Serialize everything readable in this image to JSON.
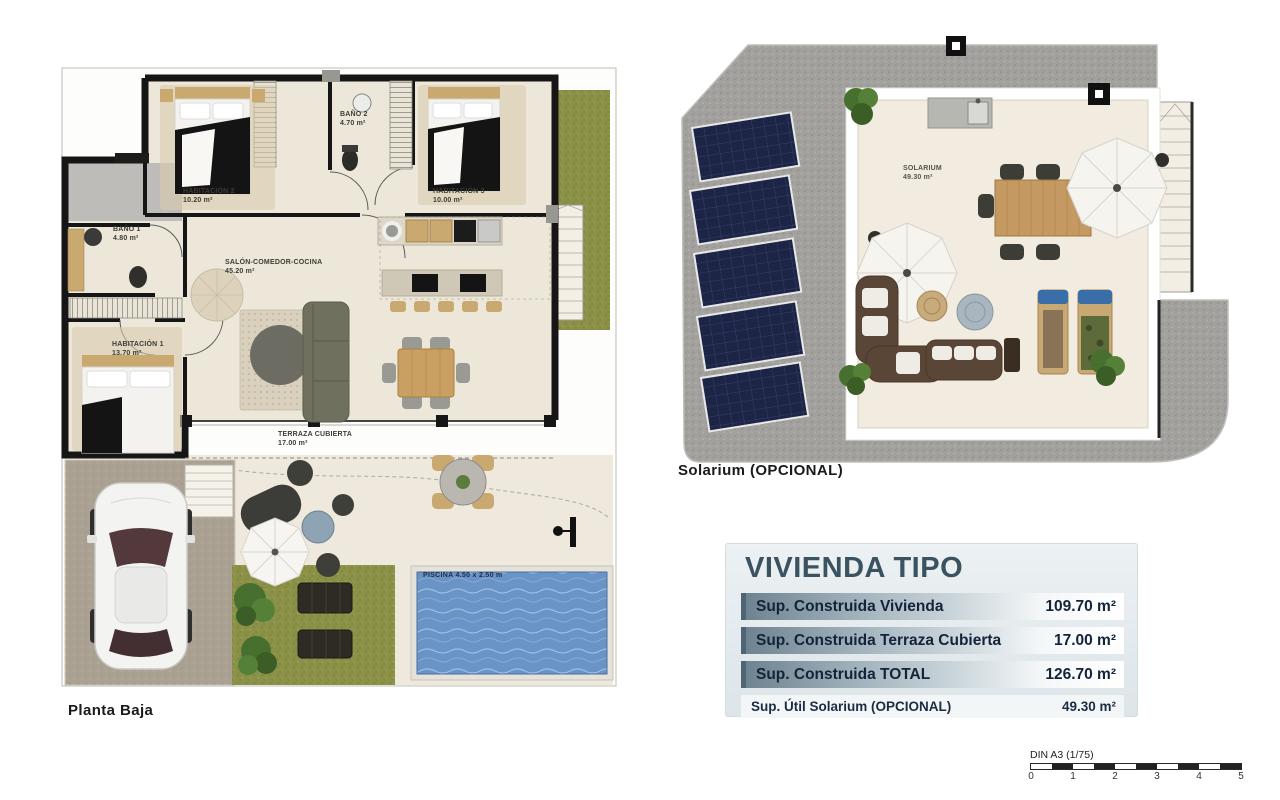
{
  "ground_floor": {
    "caption": "Planta Baja",
    "rooms": {
      "hab2": {
        "name": "HABITACIÓN 2",
        "area": "10.20 m²"
      },
      "bano2": {
        "name": "BAÑO 2",
        "area": "4.70 m²"
      },
      "hab3": {
        "name": "HABITACIÓN 3",
        "area": "10.00 m²"
      },
      "bano1": {
        "name": "BAÑO 1",
        "area": "4.80 m²"
      },
      "hab1": {
        "name": "HABITACIÓN 1",
        "area": "13.70 m²"
      },
      "salon": {
        "name": "SALÓN-COMEDOR-COCINA",
        "area": "45.20 m²"
      },
      "terraza": {
        "name": "TERRAZA CUBIERTA",
        "area": "17.00 m²"
      }
    },
    "pool_label": "PISCINA 4.50 x 2.50 m"
  },
  "solarium_plan": {
    "caption": "Solarium (OPCIONAL)",
    "room": {
      "name": "SOLARIUM",
      "area": "49.30 m²"
    },
    "solar_panel_count": 5
  },
  "summary": {
    "title": "VIVIENDA TIPO",
    "rows": [
      {
        "label": "Sup. Construida Vivienda",
        "value": "109.70 m²"
      },
      {
        "label": "Sup. Construida Terraza Cubierta",
        "value": "17.00 m²"
      },
      {
        "label": "Sup. Construida TOTAL",
        "value": "126.70 m²"
      }
    ],
    "optional_row": {
      "label": "Sup. Útil Solarium (OPCIONAL)",
      "value": "49.30 m²"
    }
  },
  "scale_bar": {
    "label": "DIN A3 (1/75)",
    "ticks": [
      "0",
      "1",
      "2",
      "3",
      "4",
      "5"
    ]
  },
  "colors": {
    "wall": "#161616",
    "floor": "#ede7da",
    "grass": "#8c9148",
    "gravel": "#a2a19d",
    "pool": "#6a93c6",
    "solar_panel": "#1d2547",
    "accent_title": "#3b5361"
  }
}
